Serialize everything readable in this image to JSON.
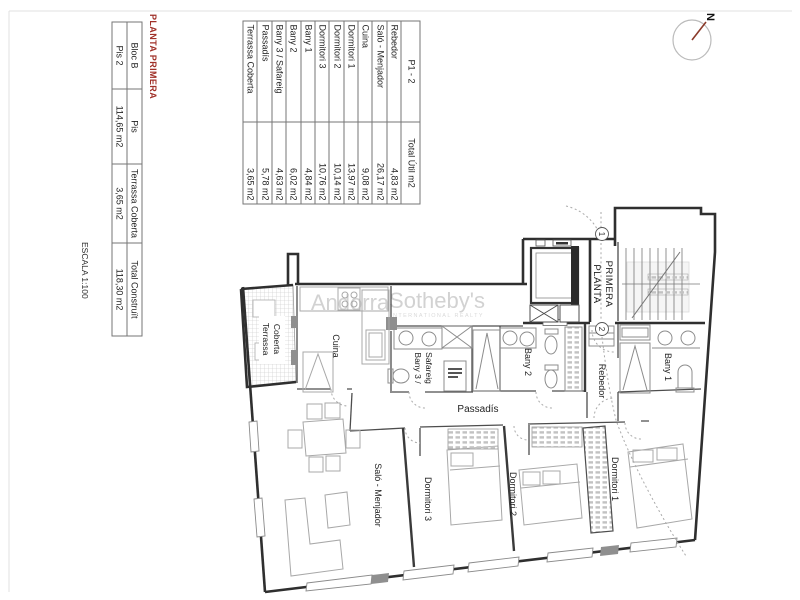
{
  "sheet": {
    "planta_title": "PLANTA PRIMERA",
    "escala": "ESCALA 1:100"
  },
  "area_table": {
    "header": {
      "name": "P1 - 2",
      "value": "Total Útil m2"
    },
    "rows": [
      {
        "name": "Rebedor",
        "value": "4,83 m2"
      },
      {
        "name": "Saló - Menjador",
        "value": "26,17 m2"
      },
      {
        "name": "Cuina",
        "value": "9,08 m2"
      },
      {
        "name": "Dormitori 1",
        "value": "13,97 m2"
      },
      {
        "name": "Dormitori 2",
        "value": "10,14 m2"
      },
      {
        "name": "Dormitori 3",
        "value": "10,76 m2"
      },
      {
        "name": "Bany 1",
        "value": "4,84 m2"
      },
      {
        "name": "Bany 2",
        "value": "6,02 m2"
      },
      {
        "name": "Bany 3 / Safareig",
        "value": "4,63 m2"
      },
      {
        "name": "Passadís",
        "value": "5,78 m2"
      },
      {
        "name": "Terrassa Coberta",
        "value": "3,65 m2"
      }
    ]
  },
  "summary_table": {
    "headers": [
      "Bloc B",
      "Pis",
      "Terrassa Coberta",
      "Total Construït"
    ],
    "values": [
      "Pis 2",
      "114,65 m2",
      "3,65 m2",
      "118,30 m2"
    ]
  },
  "watermark": {
    "brand1": "Andorra",
    "brand2": "Sotheby's",
    "tagline": "INTERNATIONAL REALTY"
  },
  "compass": {
    "north_label": "N"
  },
  "plan": {
    "labels": {
      "terrassa_line1": "Terrassa",
      "terrassa_line2": "Coberta",
      "cuina": "Cuina",
      "bany3_line1": "Bany 3 /",
      "bany3_line2": "Safareig",
      "bany2": "Bany 2",
      "bany1": "Bany 1",
      "rebedor": "Rebedor",
      "passadis": "Passadís",
      "salo": "Saló - Menjador",
      "dorm1": "Dormitori 1",
      "dorm2": "Dormitori 2",
      "dorm3": "Dormitori 3",
      "planta_line1": "PLANTA",
      "planta_line2": "PRIMERA"
    },
    "markers": {
      "level1": "1",
      "level2": "2"
    },
    "colors": {
      "title_red": "#a03028",
      "wall": "#2f2f2f",
      "furniture": "#a8a8a8",
      "watermark_gray": "#d2d2d2",
      "compass_needle": "#8a3a2a"
    }
  }
}
